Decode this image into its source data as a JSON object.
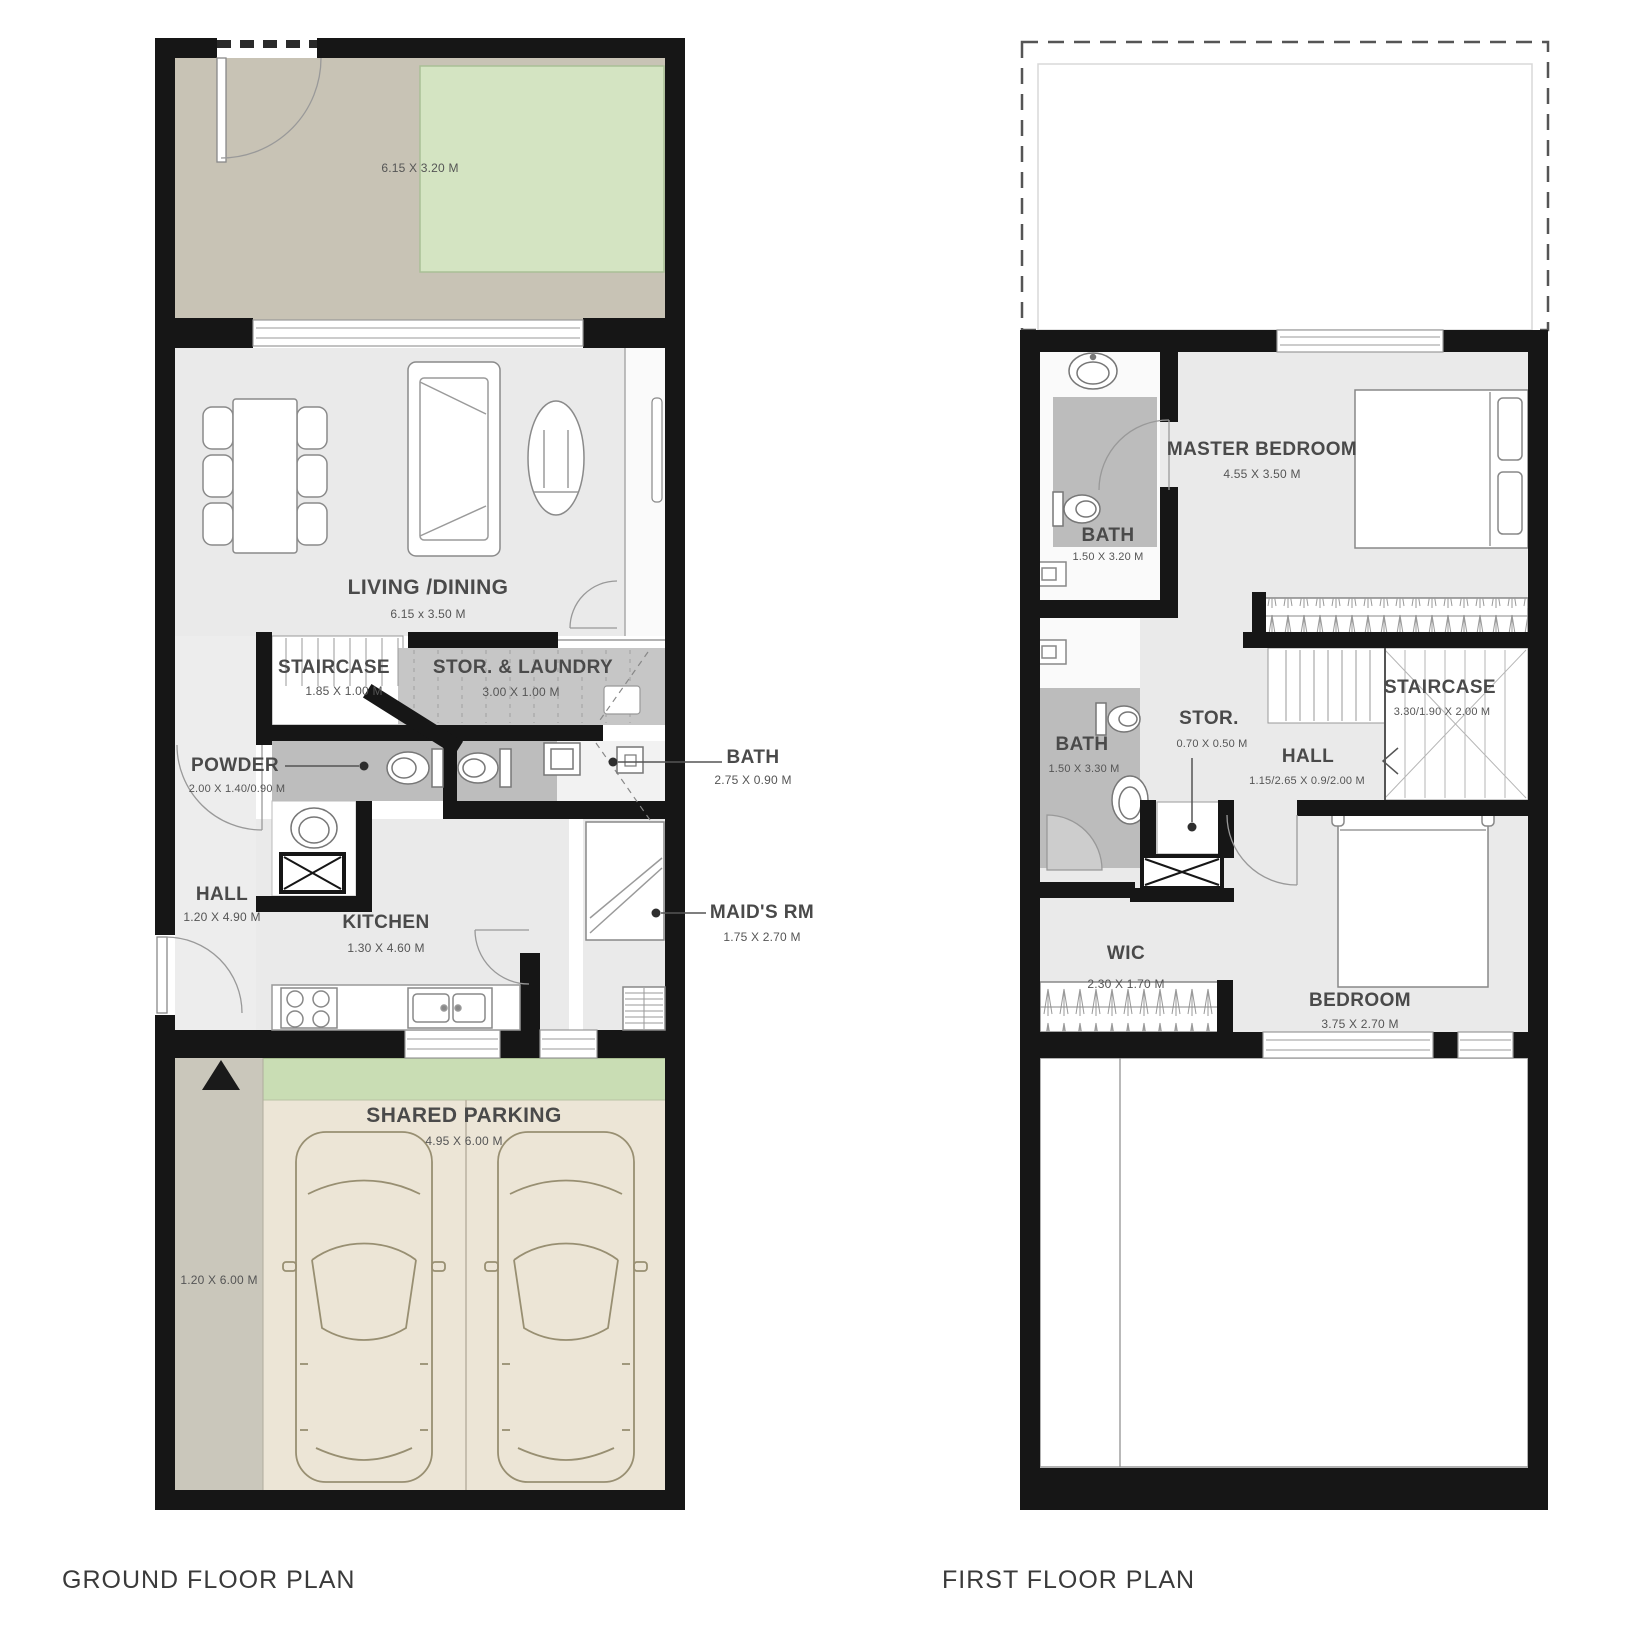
{
  "ground_floor": {
    "title": "GROUND FLOOR PLAN",
    "terrace": {
      "dims": "6.15 X 3.20 M"
    },
    "living_dining": {
      "name": "LIVING /DINING",
      "dims": "6.15 x 3.50 M"
    },
    "staircase": {
      "name": "STAIRCASE",
      "dims": "1.85 X 1.00 M"
    },
    "storage_laundry": {
      "name": "STOR. & LAUNDRY",
      "dims": "3.00 X 1.00 M"
    },
    "powder": {
      "name": "POWDER",
      "dims": "2.00 X 1.40/0.90 M"
    },
    "bath": {
      "name": "BATH",
      "dims": "2.75 X 0.90 M"
    },
    "hall": {
      "name": "HALL",
      "dims": "1.20 X 4.90 M"
    },
    "kitchen": {
      "name": "KITCHEN",
      "dims": "1.30 X 4.60 M"
    },
    "maids_room": {
      "name": "MAID'S RM",
      "dims": "1.75 X 2.70 M"
    },
    "shared_parking": {
      "name": "SHARED PARKING",
      "dims": "4.95 X 6.00 M"
    },
    "side_yard": {
      "dims": "1.20 X 6.00 M"
    }
  },
  "first_floor": {
    "title": "FIRST FLOOR PLAN",
    "master_bedroom": {
      "name": "MASTER BEDROOM",
      "dims": "4.55 X 3.50 M"
    },
    "bath_top": {
      "name": "BATH",
      "dims": "1.50 X 3.20 M"
    },
    "bath_mid": {
      "name": "BATH",
      "dims": "1.50 X 3.30 M"
    },
    "storage": {
      "name": "STOR.",
      "dims": "0.70 X 0.50 M"
    },
    "staircase": {
      "name": "STAIRCASE",
      "dims": "3.30/1.90 X 2.00 M"
    },
    "hall": {
      "name": "HALL",
      "dims": "1.15/2.65 X 0.9/2.00 M"
    },
    "wic": {
      "name": "WIC",
      "dims": "2.30 X 1.70 M"
    },
    "bedroom": {
      "name": "BEDROOM",
      "dims": "3.75 X 2.70 M"
    }
  },
  "colors": {
    "wall": "#161616",
    "floor": "#eaeaea",
    "wet_area": "#bcbcbc",
    "terrace": "#c8c3b5",
    "garden": "#d4e4c2",
    "lawn_strip": "#c9ddb4",
    "parking": "#ece5d6",
    "side_yard": "#cac7bb"
  }
}
